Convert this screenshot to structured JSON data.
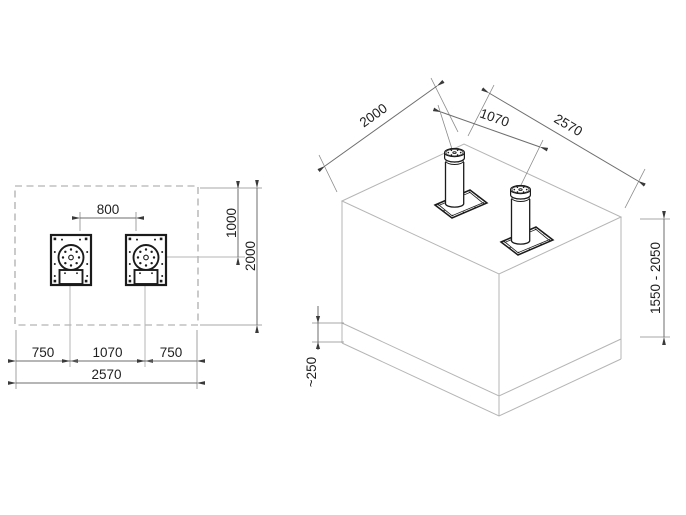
{
  "drawing": {
    "background": "#ffffff",
    "colors": {
      "object_line": "#1b1b1b",
      "construction_line": "#b5b5b5",
      "dimension_line": "#6e6e6e",
      "extension_line": "#8a8a8a",
      "dashed_outline": "#a0a0a0",
      "text": "#1f1f1f",
      "arrow": "#3a3a3a"
    },
    "plan_view": {
      "dims": {
        "clearance_between_bollards": "800",
        "edge_offset": "1000",
        "foundation_depth": "2000",
        "margin_left": "750",
        "bollard_spacing": "1070",
        "margin_right": "750",
        "foundation_width": "2570"
      }
    },
    "iso_view": {
      "dims": {
        "foundation_depth": "2000",
        "bollard_spacing": "1070",
        "foundation_width": "2570",
        "installation_height_range": "1550 - 2050",
        "slab_thickness": "~250"
      }
    }
  }
}
